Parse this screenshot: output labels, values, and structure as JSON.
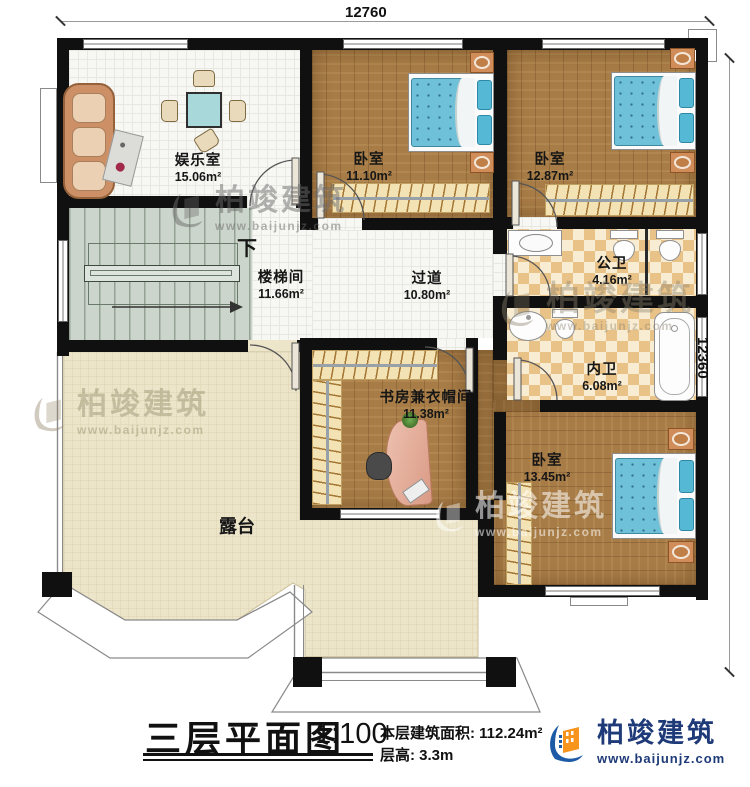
{
  "dimensions": {
    "top": "12760",
    "right": "12360"
  },
  "rooms": {
    "entertainment": {
      "name": "娱乐室",
      "area": "15.06m²"
    },
    "bedroom1": {
      "name": "卧室",
      "area": "11.10m²"
    },
    "bedroom2": {
      "name": "卧室",
      "area": "12.87m²"
    },
    "public_bath": {
      "name": "公卫",
      "area": "4.16m²"
    },
    "stairwell": {
      "name": "楼梯间",
      "area": "11.66m²"
    },
    "hallway": {
      "name": "过道",
      "area": "10.80m²"
    },
    "inner_bath": {
      "name": "内卫",
      "area": "6.08m²"
    },
    "study": {
      "name": "书房兼衣帽间",
      "area": "11.38m²"
    },
    "bedroom3": {
      "name": "卧室",
      "area": "13.45m²"
    },
    "terrace": {
      "name": "露台"
    }
  },
  "stairs": {
    "down_label": "下"
  },
  "title_block": {
    "title": "三层平面图",
    "scale": "1:100",
    "floor_area_label": "本层建筑面积:",
    "floor_area_value": "112.24m²",
    "floor_height_label": "层高:",
    "floor_height_value": "3.3m"
  },
  "brand": {
    "name": "柏竣建筑",
    "website": "www.baijunjz.com"
  },
  "colors": {
    "wall": "#101010",
    "wood_floor": "#a87c46",
    "tile_light": "#f8ecd2",
    "tile_dark": "#e9c287",
    "terrace_floor": "#ece5c9",
    "stairs_floor": "#ccd5cb",
    "bed_blue": "#6fc1d9",
    "brand_blue": "#1e3a78",
    "brand_orange": "#f7941d"
  }
}
